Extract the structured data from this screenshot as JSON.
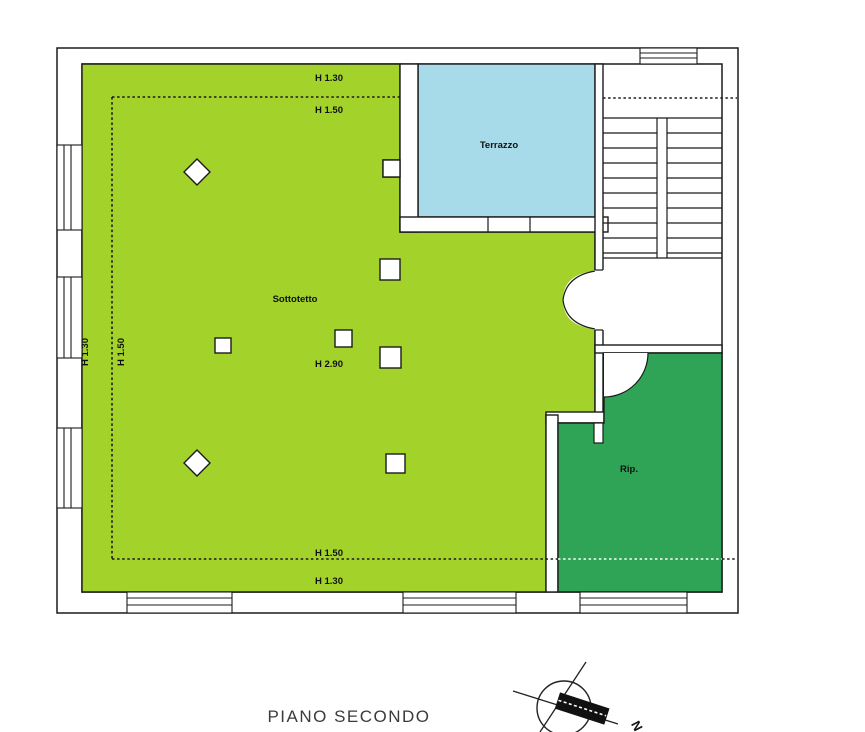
{
  "floor_plan": {
    "title": "PIANO SECONDO",
    "rooms": {
      "sottotetto": {
        "label": "Sottotetto",
        "color": "#a3d32a"
      },
      "terrazzo": {
        "label": "Terrazzo",
        "color": "#a8dbea"
      },
      "rip": {
        "label": "Rip.",
        "color": "#2fa457"
      }
    },
    "annotations": {
      "top_outside_dashed": "H 1.30",
      "top_inside_dashed": "H 1.50",
      "bottom_inside_dashed": "H 1.50",
      "bottom_outside_dashed": "H 1.30",
      "left_outside_dashed": "H 1.30",
      "left_inside_dashed": "H 1.50",
      "center_height": "H 2.90"
    },
    "compass": {
      "north_label": "N"
    },
    "colors": {
      "wall_line": "#1b1b1b",
      "background": "#ffffff"
    }
  }
}
